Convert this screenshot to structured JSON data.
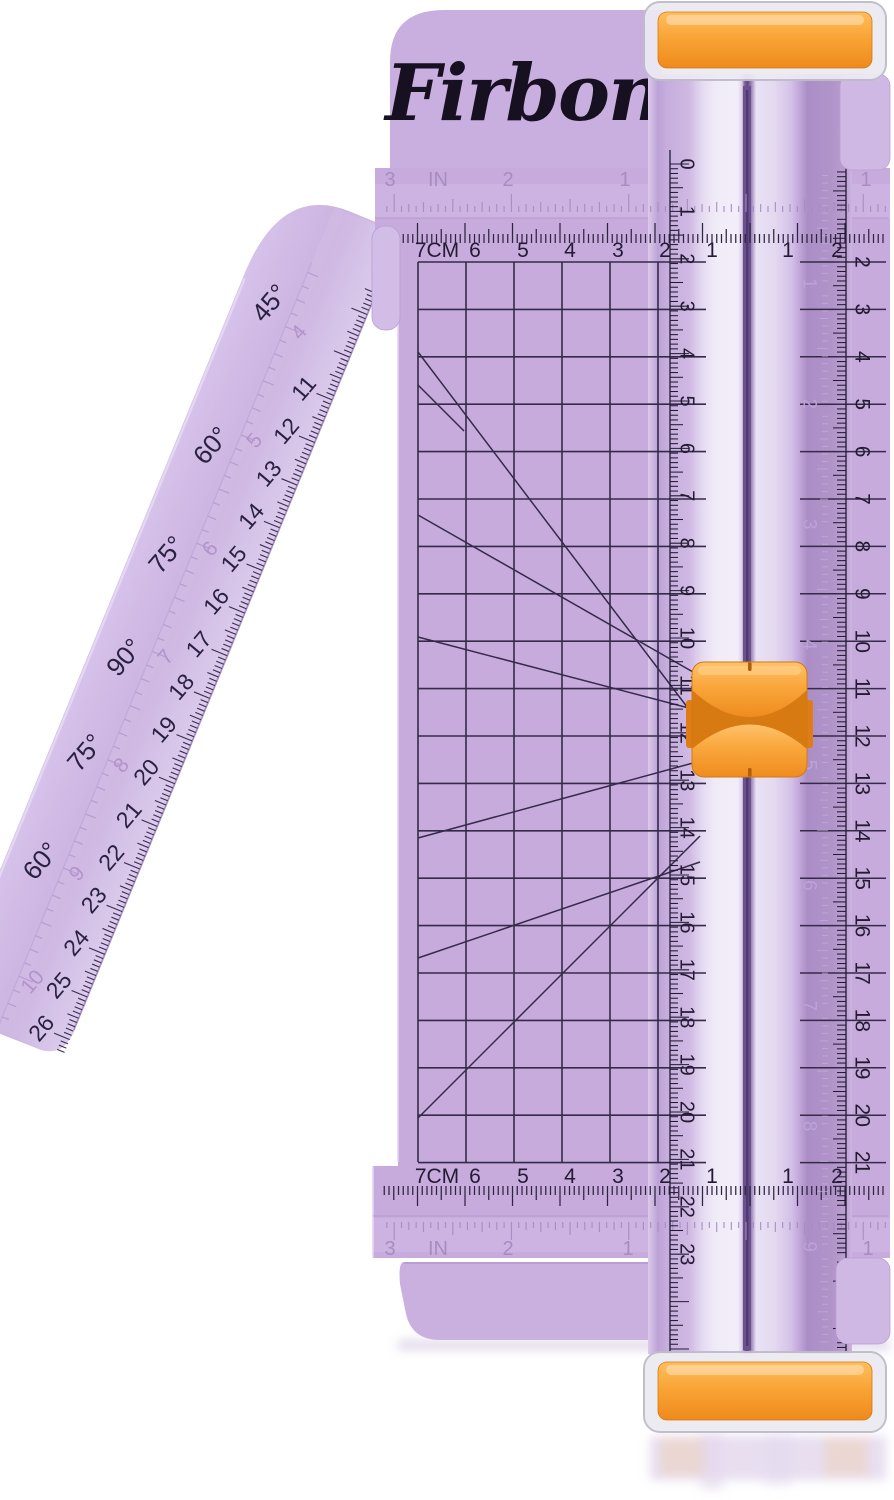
{
  "image_type": "product-photo",
  "product": {
    "brand": "Firbon",
    "item": "portable paper trimmer with swing-out ruler arm",
    "body_color_hex": "#c7abdd",
    "accent_color_hex": "#f9a63b",
    "print_color_hex": "#241b33"
  },
  "logo": {
    "text": "Firbon"
  },
  "scales": {
    "top_inch": {
      "labels": [
        "3",
        "IN",
        "2",
        "1",
        "1"
      ]
    },
    "top_cm": {
      "labels": [
        "7CM",
        "6",
        "5",
        "4",
        "3",
        "2",
        "1",
        "1",
        "2"
      ]
    },
    "bottom_cm": {
      "labels": [
        "7CM",
        "6",
        "5",
        "4",
        "3",
        "2",
        "1",
        "1",
        "2"
      ]
    },
    "bottom_inch": {
      "labels": [
        "3",
        "IN",
        "2",
        "1",
        "1"
      ]
    },
    "rail_left_cm": {
      "labels": [
        "0",
        "1",
        "2",
        "3",
        "4",
        "5",
        "6",
        "7",
        "8",
        "9",
        "10",
        "11",
        "12",
        "13",
        "14",
        "15",
        "16",
        "17",
        "18",
        "19",
        "20",
        "21",
        "22",
        "23"
      ]
    },
    "right_edge_cm": {
      "labels": [
        "2",
        "3",
        "4",
        "5",
        "6",
        "7",
        "8",
        "9",
        "10",
        "11",
        "12",
        "13",
        "14",
        "15",
        "16",
        "17",
        "18",
        "19",
        "20",
        "21"
      ]
    },
    "rail_right_inch_faint": {
      "labels": [
        "1",
        "2",
        "3",
        "4",
        "5",
        "6",
        "7",
        "8",
        "9"
      ]
    }
  },
  "arm": {
    "angle_labels": [
      "45°",
      "60°",
      "75°",
      "90°",
      "75°",
      "60°",
      "45°"
    ],
    "cm_labels": [
      "11",
      "12",
      "13",
      "14",
      "15",
      "16",
      "17",
      "18",
      "19",
      "20",
      "21",
      "22",
      "23",
      "24",
      "25",
      "26"
    ],
    "inch_labels": [
      "4",
      "5",
      "6",
      "7",
      "8",
      "9",
      "10"
    ]
  }
}
